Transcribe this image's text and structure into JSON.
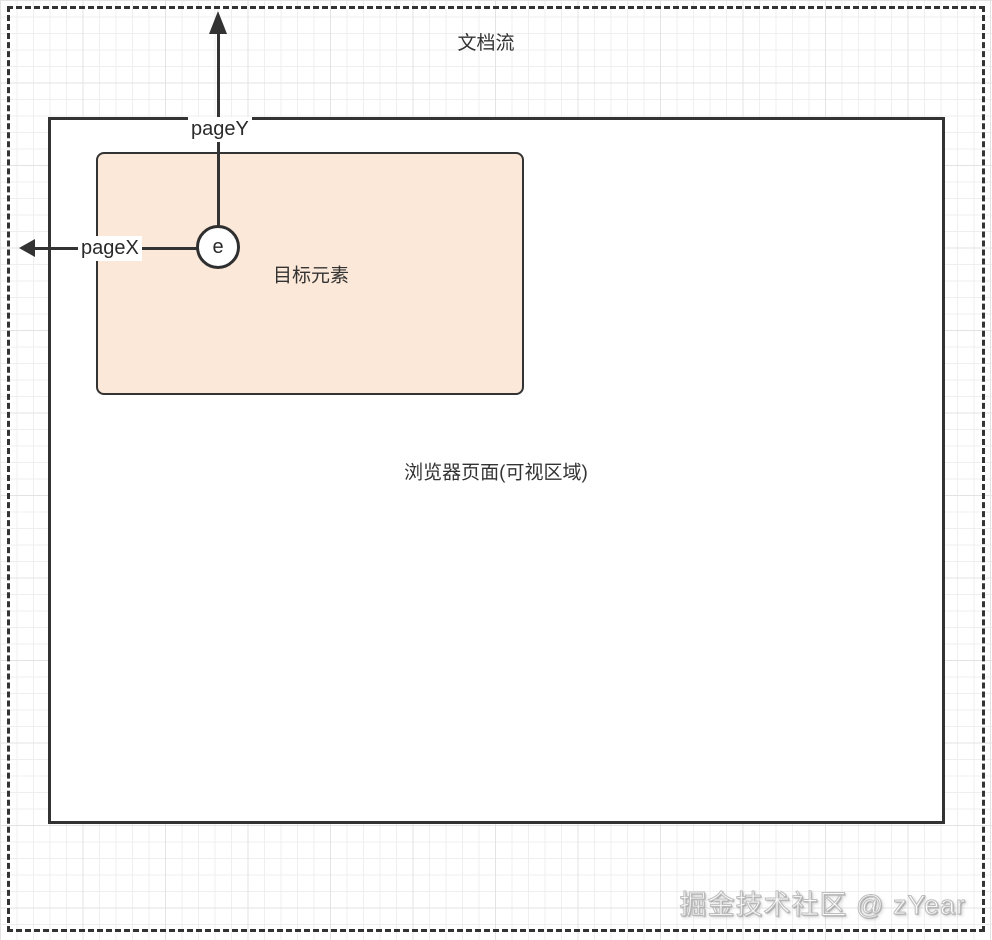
{
  "diagram": {
    "doc_flow_label": "文档流",
    "viewport_label": "浏览器页面(可视区域)",
    "target_label": "目标元素",
    "event_label": "e",
    "pagex_label": "pageX",
    "pagey_label": "pageY",
    "watermark": "掘金技术社区 @ zYear",
    "colors": {
      "stroke": "#333333",
      "target_fill": "#fce8d8",
      "grid_minor": "#efefef",
      "grid_major": "#e3e3e3",
      "background": "#ffffff",
      "label_background": "#ffffff"
    }
  }
}
